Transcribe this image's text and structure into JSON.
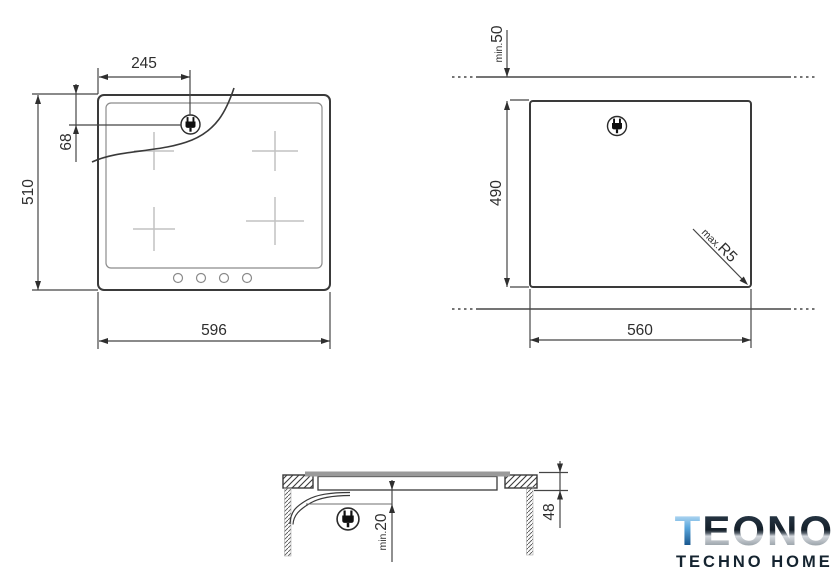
{
  "colors": {
    "line": "#3a3a3a",
    "zone_marker": "#c2c2c2",
    "glass_fill": "#9a9a9a",
    "logo_navy": "#152430",
    "logo_blue": "#4a9bd8",
    "logo_silver": "#9aa2aa"
  },
  "icons": {
    "plug": "power-plug"
  },
  "hob_top_view": {
    "width": "596",
    "height": "510",
    "plug_offset_x": "245",
    "plug_offset_y": "68"
  },
  "cutout_view": {
    "width": "560",
    "height": "490",
    "rear_clearance_prefix": "min.",
    "rear_clearance_value": "50",
    "corner_radius_prefix": "max.",
    "corner_radius_value": "R5"
  },
  "section_view": {
    "depth": "48",
    "below_clearance_prefix": "min.",
    "below_clearance_value": "20"
  },
  "logo": {
    "brand_initial": "T",
    "brand_rest": "EONO",
    "tagline": "TECHNO HOME"
  }
}
